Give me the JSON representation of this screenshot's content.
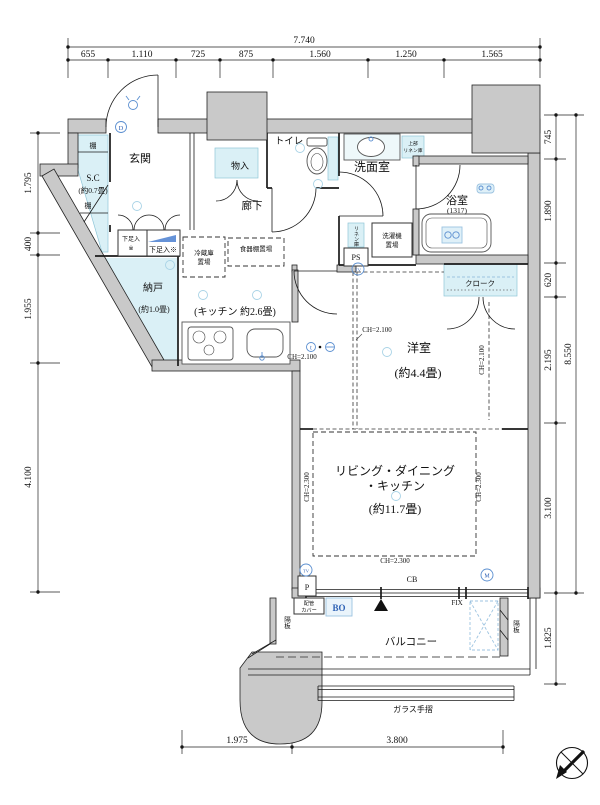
{
  "colors": {
    "wall": "#c9c9c9",
    "aqua": "#daf0f6",
    "blue": "#2f62b5",
    "lightblue": "#9cc3e0",
    "ink": "#1a1a1a"
  },
  "dims": {
    "top": {
      "total": "7.740",
      "segments": [
        "655",
        "1.110",
        "725",
        "875",
        "1.560",
        "1.250",
        "1.565"
      ]
    },
    "left": {
      "segments": [
        "1.795",
        "400",
        "1.955",
        "4.100"
      ]
    },
    "right": {
      "total": "8.550",
      "segments": [
        "745",
        "1.890",
        "620",
        "2.195",
        "3.100"
      ],
      "balcony": "1.825"
    },
    "bottom": {
      "segments": [
        "1.975",
        "3.800"
      ]
    }
  },
  "rooms": {
    "genkan": "玄関",
    "sc": "S.C",
    "sc_size": "(約0.7畳)",
    "shelf": "棚",
    "shoe_a1": "下足入",
    "shoe_a2": "※",
    "shoe_b": "下足入※",
    "monoire": "物入",
    "toilet": "トイレ",
    "hall": "廊下",
    "washroom": "洗面室",
    "bath": "浴室",
    "bath_size": "(1317)",
    "linen_upper_1": "上部",
    "linen_upper_2": "リネン庫",
    "linen": "リネン庫",
    "ps": "PS",
    "washer_1": "洗濯機",
    "washer_2": "置場",
    "fridge_1": "冷蔵庫",
    "fridge_2": "置場",
    "cupboard": "食器棚置場",
    "nando": "納戸",
    "nando_size": "(約1.0畳)",
    "kitchen": "(キッチン 約2.6畳)",
    "cloak": "クローク",
    "bedroom": "洋室",
    "bedroom_size": "(約4.4畳)",
    "ldk_1": "リビング・ダイニング",
    "ldk_2": "・キッチン",
    "ldk_size": "(約11.7畳)",
    "balcony": "バルコニー"
  },
  "annotations": {
    "ch2100": "CH=2.100",
    "ch2300": "CH=2.300",
    "cb": "CB",
    "fix": "FIX",
    "bo": "BO",
    "p": "P",
    "pipe_1": "配管",
    "pipe_2": "カバー",
    "partition": "隔板",
    "glass_rail": "ガラス手摺",
    "marker_d": "D",
    "marker_tv": "TV",
    "marker_m": "M",
    "marker_t": "t"
  }
}
